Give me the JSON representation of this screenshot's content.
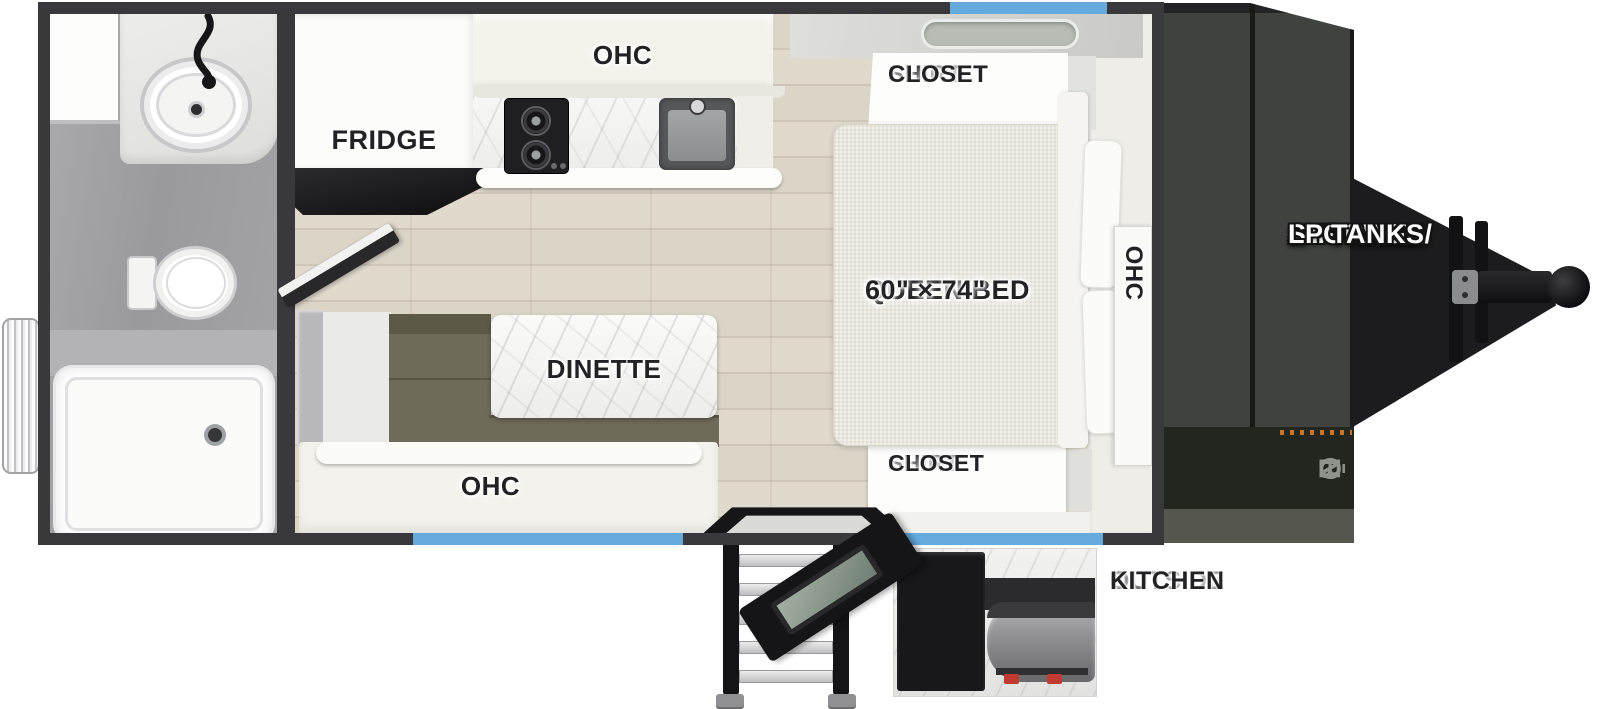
{
  "title": "Travel Trailer Floor Plan",
  "labels": {
    "fridge": "FRIDGE",
    "kitchen_ohc": "OHC",
    "dinette": "DINETTE",
    "dinette_ohc": "OHC",
    "bed_ohc": "OHC",
    "queen_bed": {
      "line1": "QUEEN BED",
      "line2": "60\" × 74\""
    },
    "shirt_closet": {
      "line1": "SHIRT",
      "line2": "CLOSET"
    },
    "outside_kitchen": {
      "line1": "OUTSIDE",
      "line2": "KITCHEN"
    },
    "a_frame": {
      "line1": "A-FRAME",
      "line2": "STORAGE/",
      "line3": "LP TANKS"
    }
  },
  "front_logo": "NŌBO",
  "colors": {
    "wall": "#39383c",
    "window_accent": "#66a9dd",
    "bench_olive": "#6f6b5a",
    "storage_panel": "#40433d",
    "hitch_black": "#1c1c1e",
    "label_ink": "#222225",
    "logo_orange": "#c8742a"
  }
}
